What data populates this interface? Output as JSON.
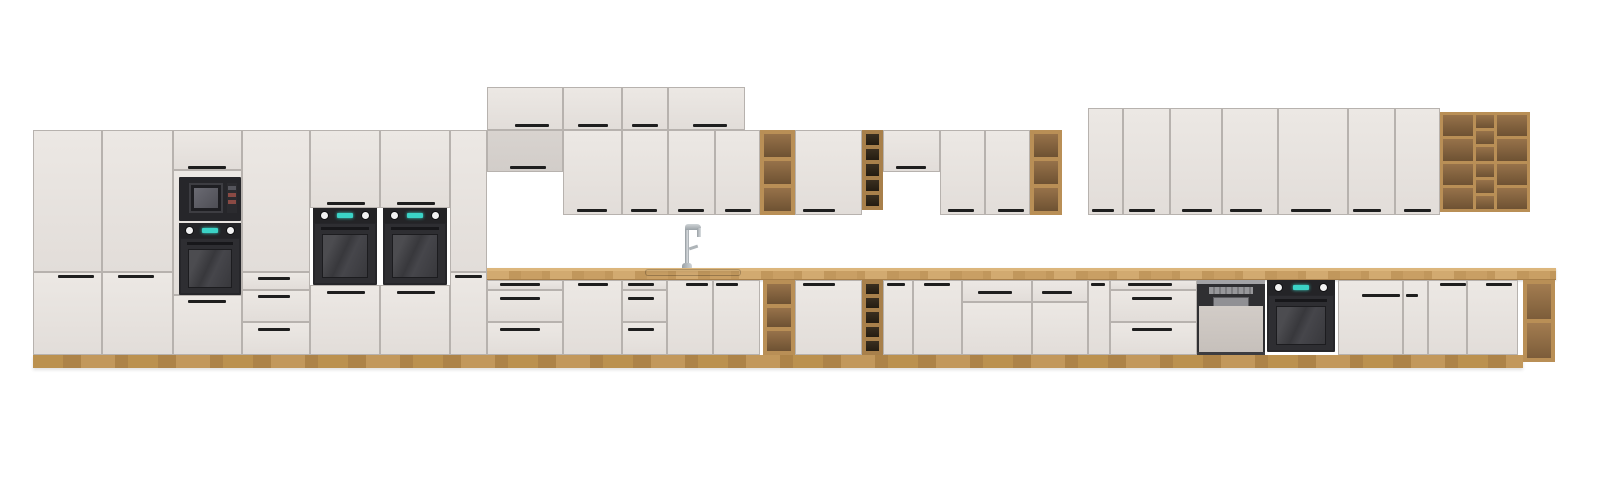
{
  "meta": {
    "type": "3d-product-render",
    "subject": "Modular kitchen cabinet lineup: tall oven/microwave columns, wall cabinets, open oak shelf units, wine racks, sink with faucet, dishwasher and built-in ovens on a long oak worktop",
    "canvas": {
      "width": 1600,
      "height": 482
    },
    "background": "#ffffff"
  },
  "palette": {
    "front1": "#ece8e4",
    "front2": "#e2ddd9",
    "frontShade": "#d8d3cf",
    "seam": "#b7b2ae",
    "handle": "#1e1e1e",
    "counter1": "#d2aa70",
    "counter2": "#c1975c",
    "counterEdge": "#a87f49",
    "plinth1": "#bb914f",
    "plinth2": "#ad8348",
    "shelfFrame": "#b98f56",
    "shelfIn1": "#97724a",
    "shelfIn2": "#6e5233",
    "rackInterior": "#2e2517",
    "appl": "#26262a",
    "applDoor": "#2e2e32",
    "glass1": "#4c4c50",
    "glass2": "#38383c",
    "knob": "#f2f2f2",
    "display": "#3bd3c6",
    "dwBand": "#2f2f32",
    "dwPanel": "#cfc9c4",
    "steel": "#a3a3a6",
    "chrome": "#c9ced1"
  },
  "scene": {
    "items": [
      {
        "t": "wood",
        "v": "plinth",
        "n": "plinth",
        "x": 33,
        "y": 355,
        "w": 1490,
        "h": 13
      },
      {
        "t": "wood",
        "v": "counter",
        "n": "countertop",
        "x": 487,
        "y": 268,
        "w": 1069,
        "h": 12
      },
      {
        "t": "f",
        "n": "tall-cabinet-door",
        "x": 33,
        "y": 130,
        "w": 69,
        "h": 142
      },
      {
        "t": "f",
        "n": "tall-cabinet-door",
        "x": 33,
        "y": 272,
        "w": 69,
        "h": 83
      },
      {
        "t": "f",
        "n": "tall-cabinet-door",
        "x": 102,
        "y": 130,
        "w": 71,
        "h": 142
      },
      {
        "t": "f",
        "n": "tall-cabinet-door",
        "x": 102,
        "y": 272,
        "w": 71,
        "h": 83
      },
      {
        "t": "f",
        "n": "tall-cabinet-top-door",
        "x": 173,
        "y": 130,
        "w": 69,
        "h": 40
      },
      {
        "t": "f",
        "n": "appliance-housing-panel",
        "x": 173,
        "y": 170,
        "w": 69,
        "h": 125
      },
      {
        "t": "f",
        "n": "tall-cabinet-door",
        "x": 173,
        "y": 295,
        "w": 69,
        "h": 60
      },
      {
        "t": "f",
        "n": "tall-cabinet-door",
        "x": 242,
        "y": 130,
        "w": 68,
        "h": 142
      },
      {
        "t": "f",
        "n": "drawer-front",
        "x": 242,
        "y": 272,
        "w": 68,
        "h": 18
      },
      {
        "t": "f",
        "n": "drawer-front",
        "x": 242,
        "y": 290,
        "w": 68,
        "h": 32
      },
      {
        "t": "f",
        "n": "drawer-front",
        "x": 242,
        "y": 322,
        "w": 68,
        "h": 33
      },
      {
        "t": "f",
        "n": "tall-cabinet-door",
        "x": 310,
        "y": 130,
        "w": 70,
        "h": 78
      },
      {
        "t": "f",
        "n": "tall-cabinet-door",
        "x": 310,
        "y": 285,
        "w": 70,
        "h": 70
      },
      {
        "t": "f",
        "n": "tall-cabinet-door",
        "x": 380,
        "y": 130,
        "w": 70,
        "h": 78
      },
      {
        "t": "f",
        "n": "tall-cabinet-door",
        "x": 380,
        "y": 285,
        "w": 70,
        "h": 70
      },
      {
        "t": "f",
        "n": "tall-cabinet-door",
        "x": 450,
        "y": 130,
        "w": 37,
        "h": 142
      },
      {
        "t": "f",
        "n": "tall-cabinet-door",
        "x": 450,
        "y": 272,
        "w": 37,
        "h": 83
      },
      {
        "t": "f",
        "n": "top-wall-cabinet-door",
        "x": 487,
        "y": 87,
        "w": 76,
        "h": 43
      },
      {
        "t": "f",
        "n": "top-wall-cabinet-door",
        "x": 563,
        "y": 87,
        "w": 59,
        "h": 43
      },
      {
        "t": "f",
        "n": "top-wall-cabinet-door",
        "x": 622,
        "y": 87,
        "w": 46,
        "h": 43
      },
      {
        "t": "f",
        "n": "top-wall-cabinet-door",
        "x": 668,
        "y": 87,
        "w": 77,
        "h": 43
      },
      {
        "t": "f",
        "v": "shade",
        "n": "wall-cabinet-door",
        "x": 487,
        "y": 130,
        "w": 76,
        "h": 42
      },
      {
        "t": "f",
        "n": "wall-cabinet-door",
        "x": 563,
        "y": 130,
        "w": 59,
        "h": 85
      },
      {
        "t": "f",
        "n": "wall-cabinet-door",
        "x": 622,
        "y": 130,
        "w": 46,
        "h": 85
      },
      {
        "t": "f",
        "n": "wall-cabinet-door",
        "x": 668,
        "y": 130,
        "w": 47,
        "h": 85
      },
      {
        "t": "f",
        "n": "wall-cabinet-door",
        "x": 715,
        "y": 130,
        "w": 45,
        "h": 85
      },
      {
        "t": "shelfcol",
        "r": 3,
        "n": "open-shelf-wall-unit",
        "x": 760,
        "y": 130,
        "w": 35,
        "h": 85
      },
      {
        "t": "f",
        "n": "wall-cabinet-door",
        "x": 795,
        "y": 130,
        "w": 67,
        "h": 85
      },
      {
        "t": "shelfcol",
        "v": "dark",
        "r": 5,
        "n": "wine-rack-wall-unit",
        "x": 862,
        "y": 130,
        "w": 21,
        "h": 80
      },
      {
        "t": "f",
        "n": "wall-cabinet-door",
        "x": 883,
        "y": 130,
        "w": 57,
        "h": 42
      },
      {
        "t": "f",
        "n": "wall-cabinet-door",
        "x": 940,
        "y": 130,
        "w": 45,
        "h": 85
      },
      {
        "t": "f",
        "n": "wall-cabinet-door",
        "x": 985,
        "y": 130,
        "w": 45,
        "h": 85
      },
      {
        "t": "shelfcol",
        "r": 3,
        "n": "open-shelf-wall-unit",
        "x": 1030,
        "y": 130,
        "w": 32,
        "h": 85
      },
      {
        "t": "f",
        "n": "wall-cabinet-door",
        "x": 1088,
        "y": 108,
        "w": 35,
        "h": 107
      },
      {
        "t": "f",
        "n": "wall-cabinet-door",
        "x": 1123,
        "y": 108,
        "w": 47,
        "h": 107
      },
      {
        "t": "f",
        "n": "wall-cabinet-door",
        "x": 1170,
        "y": 108,
        "w": 52,
        "h": 107
      },
      {
        "t": "f",
        "n": "wall-cabinet-door",
        "x": 1222,
        "y": 108,
        "w": 56,
        "h": 107
      },
      {
        "t": "f",
        "n": "wall-cabinet-door",
        "x": 1278,
        "y": 108,
        "w": 70,
        "h": 107
      },
      {
        "t": "f",
        "n": "wall-cabinet-door",
        "x": 1348,
        "y": 108,
        "w": 47,
        "h": 107
      },
      {
        "t": "f",
        "n": "wall-cabinet-door",
        "x": 1395,
        "y": 108,
        "w": 45,
        "h": 107
      },
      {
        "t": "shelfgrid",
        "n": "open-shelf-grid-unit",
        "x": 1440,
        "y": 112,
        "w": 90,
        "h": 100,
        "c": [
          {
            "w": 30,
            "r": 4
          },
          {
            "w": 18,
            "r": 6
          },
          {
            "w": 30,
            "r": 4
          }
        ]
      },
      {
        "t": "f",
        "n": "drawer-front",
        "x": 487,
        "y": 280,
        "w": 76,
        "h": 10
      },
      {
        "t": "f",
        "n": "drawer-front",
        "x": 487,
        "y": 290,
        "w": 76,
        "h": 32
      },
      {
        "t": "f",
        "n": "drawer-front",
        "x": 487,
        "y": 322,
        "w": 76,
        "h": 33
      },
      {
        "t": "f",
        "n": "base-cabinet-door",
        "x": 563,
        "y": 280,
        "w": 59,
        "h": 75
      },
      {
        "t": "f",
        "n": "drawer-front",
        "x": 622,
        "y": 280,
        "w": 45,
        "h": 10
      },
      {
        "t": "f",
        "n": "drawer-front",
        "x": 622,
        "y": 290,
        "w": 45,
        "h": 32
      },
      {
        "t": "f",
        "n": "drawer-front",
        "x": 622,
        "y": 322,
        "w": 45,
        "h": 33
      },
      {
        "t": "f",
        "n": "sink-cabinet-door",
        "x": 667,
        "y": 280,
        "w": 46,
        "h": 75
      },
      {
        "t": "f",
        "n": "sink-cabinet-door",
        "x": 713,
        "y": 280,
        "w": 47,
        "h": 75
      },
      {
        "t": "shelfcol",
        "r": 3,
        "n": "open-shelf-base-unit",
        "x": 763,
        "y": 280,
        "w": 32,
        "h": 75
      },
      {
        "t": "f",
        "n": "base-cabinet-door",
        "x": 795,
        "y": 280,
        "w": 67,
        "h": 75
      },
      {
        "t": "shelfcol",
        "v": "dark",
        "r": 5,
        "n": "wine-rack-base-unit",
        "x": 862,
        "y": 280,
        "w": 21,
        "h": 75
      },
      {
        "t": "f",
        "n": "base-cabinet-door",
        "x": 883,
        "y": 280,
        "w": 30,
        "h": 75
      },
      {
        "t": "f",
        "n": "base-cabinet-door",
        "x": 913,
        "y": 280,
        "w": 49,
        "h": 75
      },
      {
        "t": "f",
        "n": "drawer-front",
        "x": 962,
        "y": 280,
        "w": 70,
        "h": 22
      },
      {
        "t": "f",
        "n": "base-cabinet-door",
        "x": 962,
        "y": 302,
        "w": 70,
        "h": 53
      },
      {
        "t": "f",
        "n": "drawer-front",
        "x": 1032,
        "y": 280,
        "w": 56,
        "h": 22
      },
      {
        "t": "f",
        "n": "base-cabinet-door",
        "x": 1032,
        "y": 302,
        "w": 56,
        "h": 53
      },
      {
        "t": "f",
        "n": "base-cabinet-door",
        "x": 1088,
        "y": 280,
        "w": 22,
        "h": 75
      },
      {
        "t": "f",
        "n": "drawer-front",
        "x": 1110,
        "y": 280,
        "w": 87,
        "h": 10
      },
      {
        "t": "f",
        "n": "drawer-front",
        "x": 1110,
        "y": 290,
        "w": 87,
        "h": 32
      },
      {
        "t": "f",
        "n": "drawer-front",
        "x": 1110,
        "y": 322,
        "w": 87,
        "h": 33
      },
      {
        "t": "dw",
        "n": "dishwasher",
        "x": 1197,
        "y": 280,
        "w": 68,
        "h": 75
      },
      {
        "t": "oven",
        "v": "base",
        "n": "built-in-oven",
        "x": 1267,
        "y": 280,
        "w": 68,
        "h": 72
      },
      {
        "t": "f",
        "n": "base-cabinet-door",
        "x": 1338,
        "y": 280,
        "w": 65,
        "h": 75
      },
      {
        "t": "f",
        "n": "base-cabinet-door",
        "x": 1403,
        "y": 280,
        "w": 25,
        "h": 75
      },
      {
        "t": "f",
        "n": "base-cabinet-door",
        "x": 1428,
        "y": 280,
        "w": 39,
        "h": 75
      },
      {
        "t": "f",
        "n": "base-cabinet-door",
        "x": 1467,
        "y": 280,
        "w": 51,
        "h": 75
      },
      {
        "t": "shelfcol",
        "v": "light",
        "r": 2,
        "n": "open-end-shelf",
        "x": 1523,
        "y": 280,
        "w": 32,
        "h": 82
      },
      {
        "t": "micro",
        "n": "built-in-microwave",
        "x": 179,
        "y": 177,
        "w": 62,
        "h": 44
      },
      {
        "t": "oven",
        "n": "built-in-oven",
        "x": 179,
        "y": 223,
        "w": 62,
        "h": 72
      },
      {
        "t": "oven",
        "n": "built-in-oven",
        "x": 313,
        "y": 208,
        "w": 64,
        "h": 77
      },
      {
        "t": "oven",
        "n": "built-in-oven",
        "x": 383,
        "y": 208,
        "w": 64,
        "h": 77
      },
      {
        "t": "sink",
        "n": "sink",
        "x": 645,
        "y": 269,
        "w": 96,
        "h": 7
      },
      {
        "t": "faucet",
        "n": "faucet",
        "x": 676,
        "y": 224,
        "w": 28,
        "h": 44
      },
      {
        "t": "h",
        "n": "handle",
        "x": 58,
        "y": 275,
        "w": 36
      },
      {
        "t": "h",
        "n": "handle",
        "x": 118,
        "y": 275,
        "w": 36
      },
      {
        "t": "h",
        "n": "handle",
        "x": 188,
        "y": 166,
        "w": 38
      },
      {
        "t": "h",
        "n": "handle",
        "x": 188,
        "y": 300,
        "w": 38
      },
      {
        "t": "h",
        "n": "handle",
        "x": 258,
        "y": 277,
        "w": 32
      },
      {
        "t": "h",
        "n": "handle",
        "x": 258,
        "y": 295,
        "w": 32
      },
      {
        "t": "h",
        "n": "handle",
        "x": 258,
        "y": 328,
        "w": 32
      },
      {
        "t": "h",
        "n": "handle",
        "x": 327,
        "y": 202,
        "w": 38
      },
      {
        "t": "h",
        "n": "handle",
        "x": 327,
        "y": 291,
        "w": 38
      },
      {
        "t": "h",
        "n": "handle",
        "x": 397,
        "y": 202,
        "w": 38
      },
      {
        "t": "h",
        "n": "handle",
        "x": 397,
        "y": 291,
        "w": 38
      },
      {
        "t": "h",
        "n": "handle",
        "x": 455,
        "y": 275,
        "w": 27
      },
      {
        "t": "h",
        "n": "handle",
        "x": 515,
        "y": 124,
        "w": 34
      },
      {
        "t": "h",
        "n": "handle",
        "x": 578,
        "y": 124,
        "w": 30
      },
      {
        "t": "h",
        "n": "handle",
        "x": 632,
        "y": 124,
        "w": 26
      },
      {
        "t": "h",
        "n": "handle",
        "x": 693,
        "y": 124,
        "w": 34
      },
      {
        "t": "h",
        "n": "handle",
        "x": 510,
        "y": 166,
        "w": 36
      },
      {
        "t": "h",
        "n": "handle",
        "x": 577,
        "y": 209,
        "w": 30
      },
      {
        "t": "h",
        "n": "handle",
        "x": 631,
        "y": 209,
        "w": 26
      },
      {
        "t": "h",
        "n": "handle",
        "x": 678,
        "y": 209,
        "w": 26
      },
      {
        "t": "h",
        "n": "handle",
        "x": 725,
        "y": 209,
        "w": 26
      },
      {
        "t": "h",
        "n": "handle",
        "x": 803,
        "y": 209,
        "w": 32
      },
      {
        "t": "h",
        "n": "handle",
        "x": 896,
        "y": 166,
        "w": 30
      },
      {
        "t": "h",
        "n": "handle",
        "x": 948,
        "y": 209,
        "w": 26
      },
      {
        "t": "h",
        "n": "handle",
        "x": 998,
        "y": 209,
        "w": 26
      },
      {
        "t": "h",
        "n": "handle",
        "x": 1092,
        "y": 209,
        "w": 22
      },
      {
        "t": "h",
        "n": "handle",
        "x": 1129,
        "y": 209,
        "w": 26
      },
      {
        "t": "h",
        "n": "handle",
        "x": 1182,
        "y": 209,
        "w": 30
      },
      {
        "t": "h",
        "n": "handle",
        "x": 1230,
        "y": 209,
        "w": 32
      },
      {
        "t": "h",
        "n": "handle",
        "x": 1291,
        "y": 209,
        "w": 40
      },
      {
        "t": "h",
        "n": "handle",
        "x": 1353,
        "y": 209,
        "w": 28
      },
      {
        "t": "h",
        "n": "handle",
        "x": 1404,
        "y": 209,
        "w": 27
      },
      {
        "t": "h",
        "n": "handle",
        "x": 500,
        "y": 283,
        "w": 40
      },
      {
        "t": "h",
        "n": "handle",
        "x": 500,
        "y": 297,
        "w": 40
      },
      {
        "t": "h",
        "n": "handle",
        "x": 500,
        "y": 328,
        "w": 40
      },
      {
        "t": "h",
        "n": "handle",
        "x": 578,
        "y": 283,
        "w": 30
      },
      {
        "t": "h",
        "n": "handle",
        "x": 628,
        "y": 283,
        "w": 26
      },
      {
        "t": "h",
        "n": "handle",
        "x": 628,
        "y": 297,
        "w": 26
      },
      {
        "t": "h",
        "n": "handle",
        "x": 628,
        "y": 328,
        "w": 26
      },
      {
        "t": "h",
        "n": "handle",
        "x": 686,
        "y": 283,
        "w": 22
      },
      {
        "t": "h",
        "n": "handle",
        "x": 716,
        "y": 283,
        "w": 22
      },
      {
        "t": "h",
        "n": "handle",
        "x": 803,
        "y": 283,
        "w": 32
      },
      {
        "t": "h",
        "n": "handle",
        "x": 887,
        "y": 283,
        "w": 18
      },
      {
        "t": "h",
        "n": "handle",
        "x": 924,
        "y": 283,
        "w": 26
      },
      {
        "t": "h",
        "n": "handle",
        "x": 978,
        "y": 291,
        "w": 34
      },
      {
        "t": "h",
        "n": "handle",
        "x": 1042,
        "y": 291,
        "w": 30
      },
      {
        "t": "h",
        "n": "handle",
        "x": 1091,
        "y": 283,
        "w": 14
      },
      {
        "t": "h",
        "n": "handle",
        "x": 1128,
        "y": 283,
        "w": 44
      },
      {
        "t": "h",
        "n": "handle",
        "x": 1132,
        "y": 297,
        "w": 40
      },
      {
        "t": "h",
        "n": "handle",
        "x": 1132,
        "y": 328,
        "w": 40
      },
      {
        "t": "h",
        "n": "handle",
        "x": 1362,
        "y": 294,
        "w": 38
      },
      {
        "t": "h",
        "n": "handle",
        "x": 1406,
        "y": 294,
        "w": 12
      },
      {
        "t": "h",
        "n": "handle",
        "x": 1440,
        "y": 283,
        "w": 26
      },
      {
        "t": "h",
        "n": "handle",
        "x": 1486,
        "y": 283,
        "w": 26
      }
    ]
  }
}
